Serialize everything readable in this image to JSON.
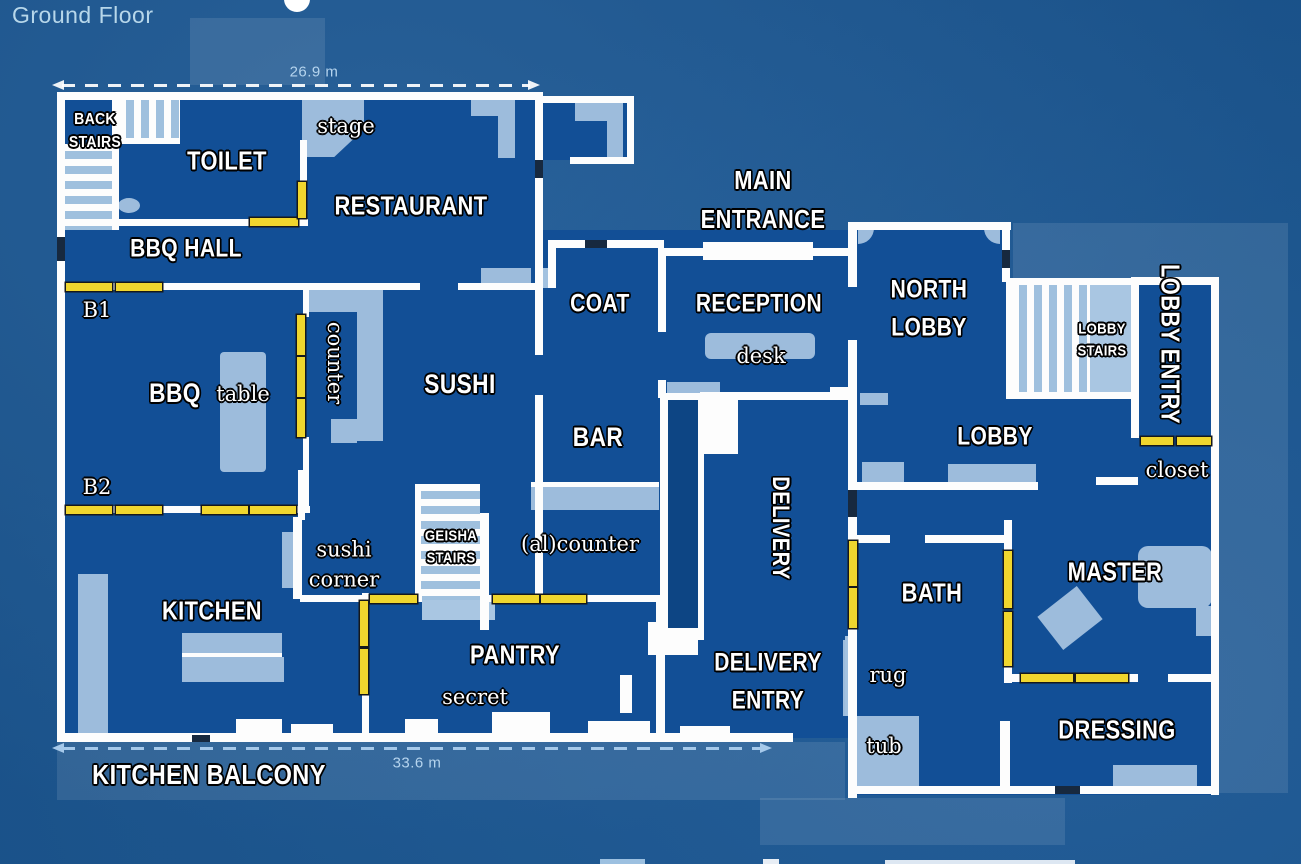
{
  "floor": {
    "label": "Ground Floor"
  },
  "dimensions": {
    "width_top": "26.9 m",
    "width_bottom": "33.6 m"
  },
  "rooms": {
    "toilet": "TOILET",
    "restaurant": "RESTAURANT",
    "bbq_hall": "BBQ HALL",
    "bbq": "BBQ",
    "sushi": "SUSHI",
    "coat": "COAT",
    "reception": "RECEPTION",
    "main_entrance": [
      "MAIN",
      "ENTRANCE"
    ],
    "north_lobby": [
      "NORTH",
      "LOBBY"
    ],
    "lobby": "LOBBY",
    "lobby_entry": "LOBBY ENTRY",
    "bar": "BAR",
    "delivery": "DELIVERY",
    "delivery_entry": [
      "DELIVERY",
      "ENTRY"
    ],
    "kitchen": "KITCHEN",
    "pantry": "PANTRY",
    "bath": "BATH",
    "master": "MASTER",
    "dressing": "DRESSING",
    "kitchen_balcony": "KITCHEN BALCONY"
  },
  "stairs": {
    "back": [
      "BACK",
      "STAIRS"
    ],
    "geisha": [
      "GEISHA",
      "STAIRS"
    ],
    "lobby": [
      "LOBBY",
      "STAIRS"
    ]
  },
  "annotations": {
    "stage": "stage",
    "b1": "B1",
    "b2": "B2",
    "table": "table",
    "counter": "counter",
    "sushi_corner": [
      "sushi",
      "corner"
    ],
    "al_counter": "(al)counter",
    "secret": "secret",
    "desk": "desk",
    "closet": "closet",
    "rug": "rug",
    "tub": "tub"
  },
  "icons": {
    "dimension_arrow_left": "arrow-left-icon",
    "dimension_arrow_right": "arrow-right-icon"
  },
  "colors": {
    "background": "#1e5e9e",
    "room_fill": "#124f96",
    "wall": "#fdfdfd",
    "door": "#f0d62e",
    "light_detail": "#a3c2e0",
    "elevator_shaft": "#0d4584",
    "dimension_text": "#b5d4ee"
  }
}
